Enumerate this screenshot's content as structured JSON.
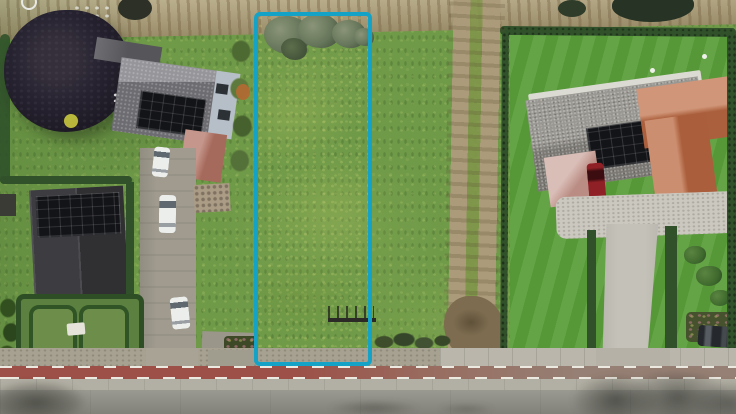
{
  "image": {
    "type": "aerial-drone-photograph",
    "subject": "Vacant grass building plot outlined with a blue rounded rectangle, situated between two residential properties with solar-panel roofs, a dirt track and hedgerows to the right, and a road with a red cycle lane along the bottom",
    "visible_text": ""
  },
  "overlay": {
    "parcel_outline_color": "#14a3c7",
    "parcel_outline_shape": "rounded-rectangle"
  },
  "palette": {
    "grass": "#6f9a48",
    "lawn_right": "#5a9e3a",
    "sand": "#b3a67f",
    "dirt": "#ab9b7a",
    "hedge": "#30512a",
    "tree_dark": "#232028",
    "roof_dark": "#3d3d41",
    "roof_gray_left": "#7e7e84",
    "roof_gray": "#8f8c86",
    "roof_orange": "#c1734c",
    "roof_pink": "#c9a198",
    "roof_terracotta_small": "#b5796b",
    "solar": "#131418",
    "wall_light": "#b6bfc7",
    "concrete": "#c4c1b9",
    "asphalt": "#94938b",
    "bike_lane": "#9c5047",
    "verge": "#a6a191",
    "car_red": "#8e2026",
    "car_dark": "#25292d",
    "vehicle_white": "#eceeec",
    "parcel_outline": "#14a3c7"
  },
  "scene": {
    "left_property": [
      "large dark copper-beech tree",
      "house with gray roof and solar array",
      "light wall with windows",
      "small terracotta roof",
      "second dark roof with solar array",
      "formal hedge parterre garden",
      "gravel driveway with white van and white cars",
      "patio"
    ],
    "parcel": [
      "grass meadow",
      "shrub row along top",
      "small fence near bottom"
    ],
    "right_property": [
      "house with speckled gray roof and solar array",
      "orange tiled roof wings",
      "pink garage roof",
      "dark red car",
      "concrete driveway",
      "hedges",
      "garden bushes",
      "dark parked car"
    ],
    "between": [
      "sandy field strip at top",
      "double-rut dirt track",
      "tall hedge line"
    ],
    "road": [
      "gravel verge",
      "red cycle lane with white dashes",
      "concrete gutter",
      "asphalt carriageway",
      "tree shadows"
    ]
  }
}
